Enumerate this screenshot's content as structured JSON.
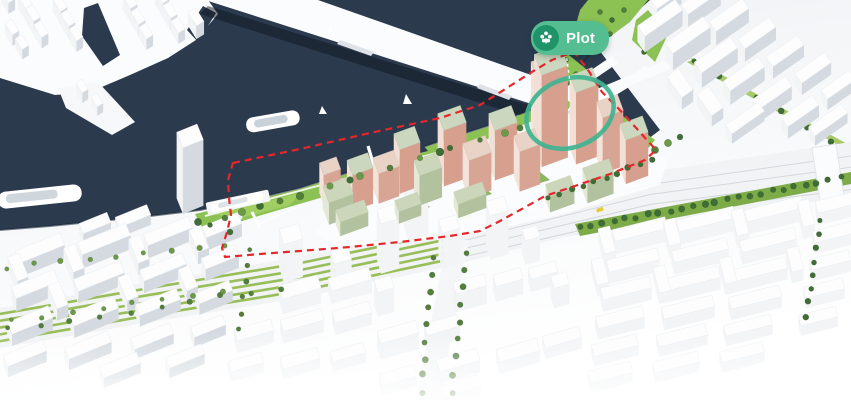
{
  "annotation": {
    "label": "Plot"
  },
  "colors": {
    "water": "#2c3a4e",
    "water_channel": "#2c3a4e",
    "shore_shadow": "#1d2938",
    "boundary_red": "#e5262b",
    "highlight_teal": "#3eb390",
    "badge_bg": "#55bd92",
    "badge_icon_bg": "#1e9468",
    "badge_text": "#ffffff",
    "park_green": "#8cc153",
    "park_light": "#a5d066",
    "median_green": "#7cab47",
    "tree_dark": "#3e6d35",
    "tree_mid": "#527f3c",
    "tree_olive": "#6a9a47",
    "development_wall": "#d69f8e",
    "development_wall_light": "#f2e0d6",
    "development_roof": "#cbd7bf",
    "bridge_white": "#fbfcfd",
    "ground_white": "#f6f7f9"
  }
}
